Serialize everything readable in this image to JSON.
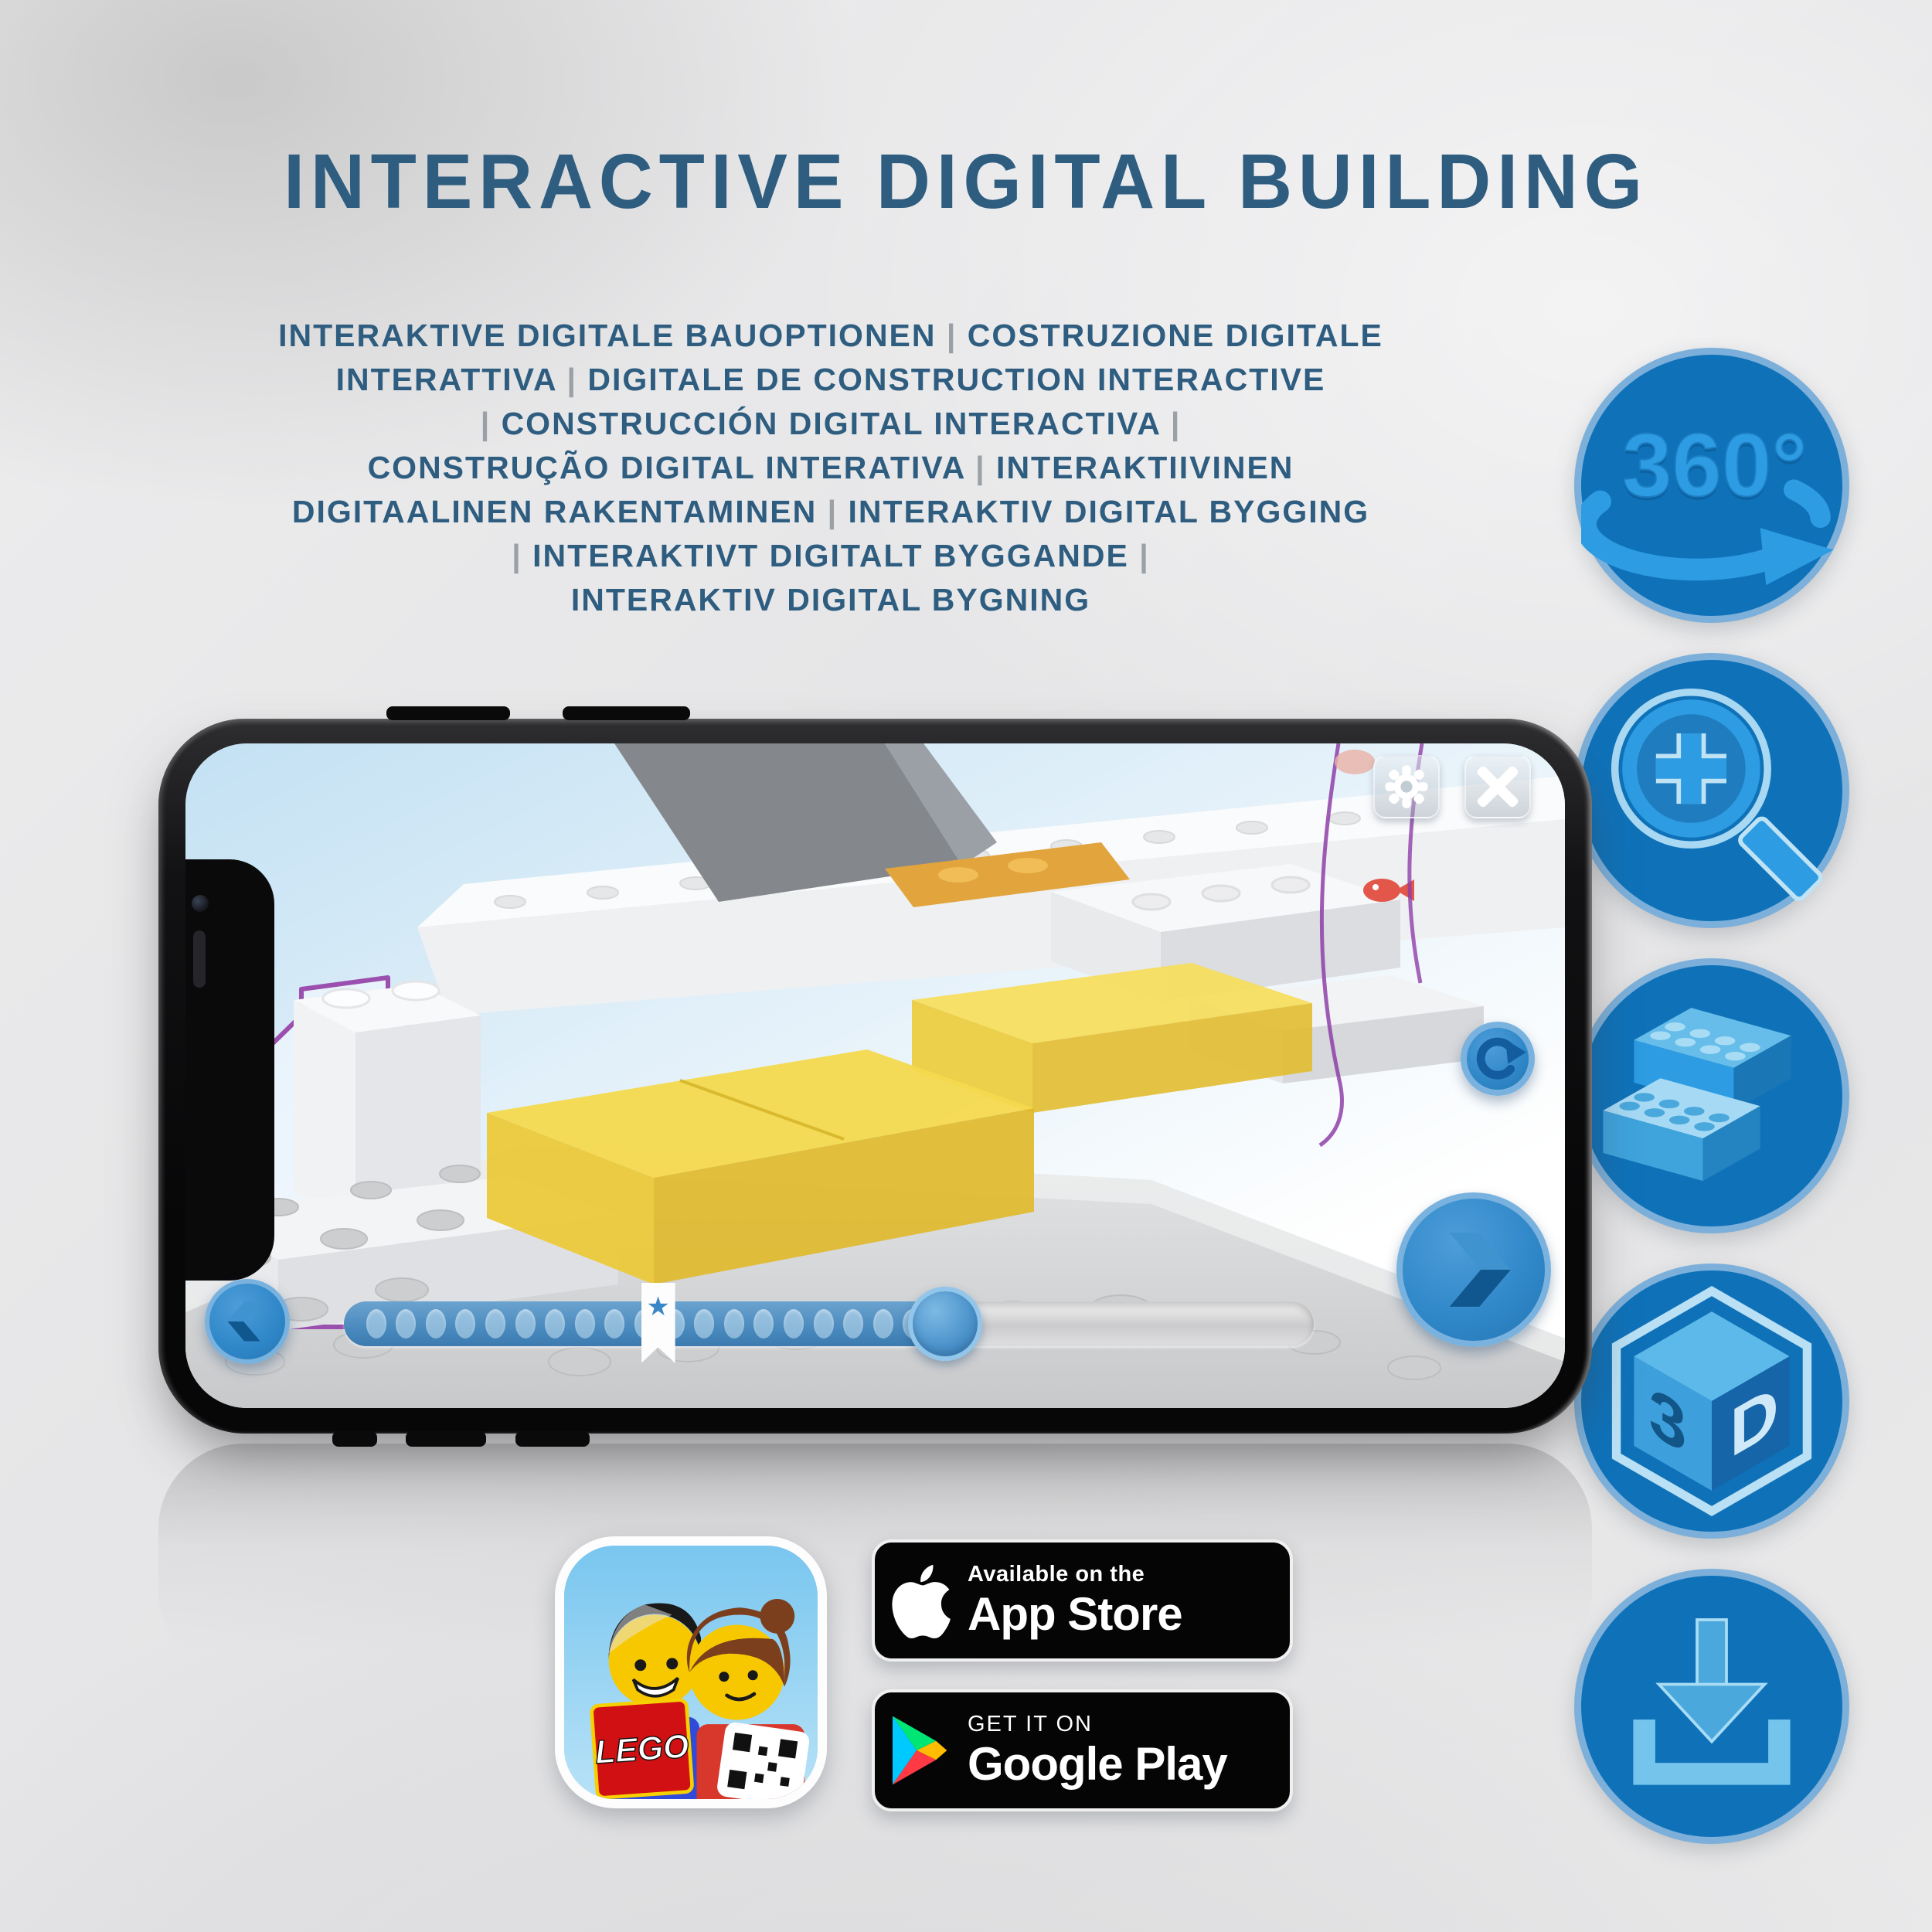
{
  "title": "INTERACTIVE DIGITAL BUILDING",
  "subtitle_lines": [
    "INTERAKTIVE DIGITALE BAUOPTIONEN | COSTRUZIONE DIGITALE",
    "INTERATTIVA | DIGITALE DE CONSTRUCTION INTERACTIVE",
    "| CONSTRUCCIÓN DIGITAL INTERACTIVA |",
    "CONSTRUÇÃO DIGITAL INTERATIVA | INTERAKTIIVINEN",
    "DIGITAALINEN RAKENTAMINEN | INTERAKTIV DIGITAL BYGGING",
    "| INTERAKTIVT DIGITALT BYGGANDE |",
    "INTERAKTIV DIGITAL BYGNING"
  ],
  "feature_icons": {
    "rotate_360_label": "360°",
    "cube_left": "3",
    "cube_right": "D"
  },
  "icons": {
    "feature_1": "360-rotation-arrow",
    "feature_2": "zoom-in-magnifier",
    "feature_3": "lego-bricks",
    "feature_4": "3d-cube",
    "feature_5": "download-tray",
    "settings": "gear",
    "close": "x-cross",
    "rotate_view": "circular-arrow",
    "previous": "chevron-left",
    "next": "chevron-right",
    "bookmark": "star-ribbon",
    "appstore": "apple-logo",
    "googleplay": "play-triangle"
  },
  "badges": {
    "appstore": {
      "tagline": "Available on the",
      "name": "App Store"
    },
    "googleplay": {
      "tagline": "GET IT ON",
      "name": "Google Play"
    }
  },
  "app_icon": {
    "logo_text": "LEGO"
  },
  "phone_ui": {
    "slider": {
      "dot_count": 19,
      "bookmark_star": "★",
      "bookmark_percent": 32.4,
      "progress_percent": 62
    }
  },
  "colors": {
    "headline": "#2e5d80",
    "circle_fill": "#0f72b9",
    "circle_border": "#7cb0da",
    "icon_blue": "#2d9ce2",
    "icon_light": "#bfe2f5",
    "icon_dark": "#135d9e",
    "slider_blue": "#4586bb",
    "brick_yellow": "#f2d84b",
    "outline_purple": "#9b4fae",
    "screen_sky": "#c3e1f3"
  }
}
